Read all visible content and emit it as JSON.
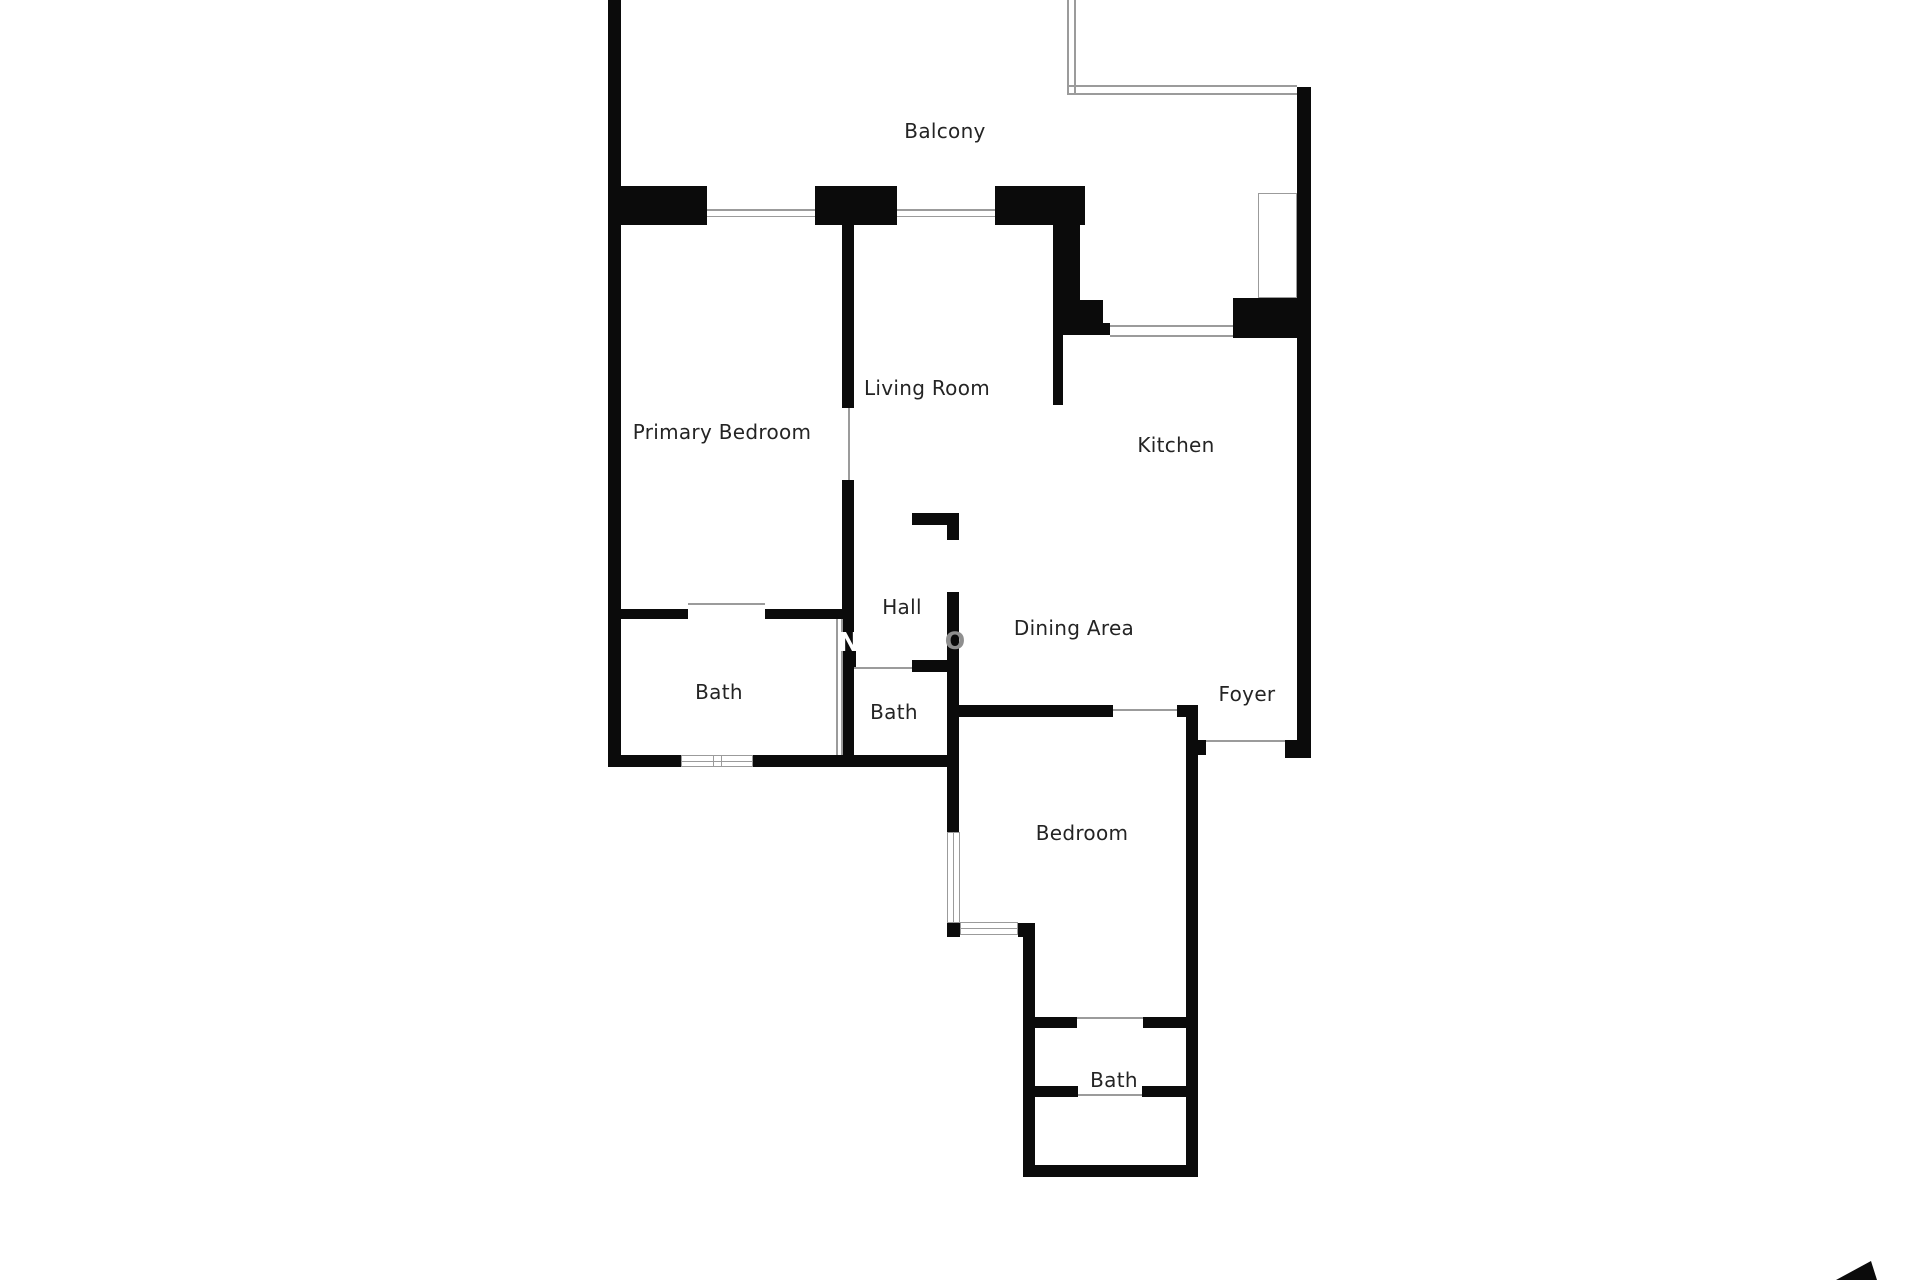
{
  "floorplan": {
    "colors": {
      "background": "#ffffff",
      "wall": "#0b0b0b",
      "thin_line": "#9b9b9b",
      "label": "#242424",
      "watermark_grey": "#8f8f8f",
      "watermark_white": "#ffffff"
    },
    "labels": [
      {
        "text": "Balcony",
        "x": 945,
        "y": 131
      },
      {
        "text": "Living Room",
        "x": 927,
        "y": 388
      },
      {
        "text": "Primary Bedroom",
        "x": 722,
        "y": 432
      },
      {
        "text": "Kitchen",
        "x": 1176,
        "y": 445
      },
      {
        "text": "Hall",
        "x": 902,
        "y": 607
      },
      {
        "text": "Dining Area",
        "x": 1074,
        "y": 628
      },
      {
        "text": "Bath",
        "x": 719,
        "y": 692
      },
      {
        "text": "Bath",
        "x": 894,
        "y": 712
      },
      {
        "text": "Foyer",
        "x": 1247,
        "y": 694
      },
      {
        "text": "Bedroom",
        "x": 1082,
        "y": 833
      },
      {
        "text": "Bath",
        "x": 1114,
        "y": 1080
      }
    ],
    "walls": [
      [
        608,
        0,
        13,
        767
      ],
      [
        608,
        186,
        99,
        39
      ],
      [
        815,
        186,
        82,
        39
      ],
      [
        995,
        186,
        90,
        39
      ],
      [
        842,
        225,
        12,
        183
      ],
      [
        842,
        480,
        12,
        287
      ],
      [
        1053,
        225,
        27,
        110
      ],
      [
        1080,
        300,
        23,
        35
      ],
      [
        1103,
        323,
        7,
        12
      ],
      [
        1053,
        335,
        10,
        70
      ],
      [
        1233,
        298,
        64,
        40
      ],
      [
        1297,
        87,
        14,
        671
      ],
      [
        1285,
        740,
        26,
        18
      ],
      [
        621,
        609,
        67,
        10
      ],
      [
        765,
        609,
        77,
        10
      ],
      [
        843,
        649,
        13,
        19
      ],
      [
        912,
        660,
        40,
        12
      ],
      [
        912,
        513,
        47,
        12
      ],
      [
        947,
        525,
        12,
        15
      ],
      [
        947,
        592,
        12,
        240
      ],
      [
        608,
        755,
        73,
        12
      ],
      [
        753,
        755,
        194,
        12
      ],
      [
        959,
        705,
        154,
        12
      ],
      [
        1177,
        705,
        21,
        12
      ],
      [
        1186,
        705,
        12,
        472
      ],
      [
        1198,
        740,
        8,
        15
      ],
      [
        947,
        923,
        13,
        14
      ],
      [
        1018,
        923,
        17,
        14
      ],
      [
        1023,
        937,
        12,
        240
      ],
      [
        1035,
        1017,
        42,
        11
      ],
      [
        1143,
        1017,
        43,
        11
      ],
      [
        1035,
        1086,
        43,
        11
      ],
      [
        1142,
        1086,
        44,
        11
      ],
      [
        1023,
        1165,
        175,
        12
      ]
    ],
    "thin_lines": [
      [
        707,
        209,
        108,
        2
      ],
      [
        707,
        216,
        108,
        1
      ],
      [
        897,
        209,
        98,
        2
      ],
      [
        897,
        216,
        98,
        1
      ],
      [
        1067,
        0,
        2,
        95
      ],
      [
        1074,
        0,
        2,
        95
      ],
      [
        1067,
        85,
        230,
        2
      ],
      [
        1067,
        93,
        230,
        2
      ],
      [
        1110,
        325,
        123,
        2
      ],
      [
        1110,
        335,
        123,
        2
      ],
      [
        848,
        408,
        2,
        72
      ],
      [
        688,
        603,
        77,
        2
      ],
      [
        854,
        667,
        58,
        2
      ],
      [
        1113,
        709,
        64,
        2
      ],
      [
        1206,
        740,
        79,
        2
      ],
      [
        1077,
        1017,
        66,
        2
      ],
      [
        1078,
        1094,
        64,
        2
      ],
      [
        836,
        619,
        2,
        136
      ],
      [
        841,
        619,
        2,
        136
      ],
      [
        713,
        755,
        1,
        12
      ],
      [
        721,
        755,
        1,
        12
      ],
      [
        681,
        761,
        72,
        1
      ],
      [
        953,
        832,
        1,
        91
      ],
      [
        960,
        928,
        58,
        1
      ]
    ],
    "window_outlines": [
      [
        1258,
        193,
        39,
        105
      ],
      [
        681,
        755,
        72,
        12
      ],
      [
        947,
        832,
        13,
        91
      ],
      [
        960,
        922,
        58,
        13
      ]
    ],
    "watermark": {
      "letters": [
        {
          "text": "N",
          "x": 849,
          "y": 643,
          "color": "#ffffff",
          "size": 26
        },
        {
          "text": "O",
          "x": 955,
          "y": 641,
          "color": "#8f8f8f",
          "size": 24
        }
      ]
    },
    "compass": {
      "points": "1871,1261 1836,1280 1877,1280"
    }
  }
}
